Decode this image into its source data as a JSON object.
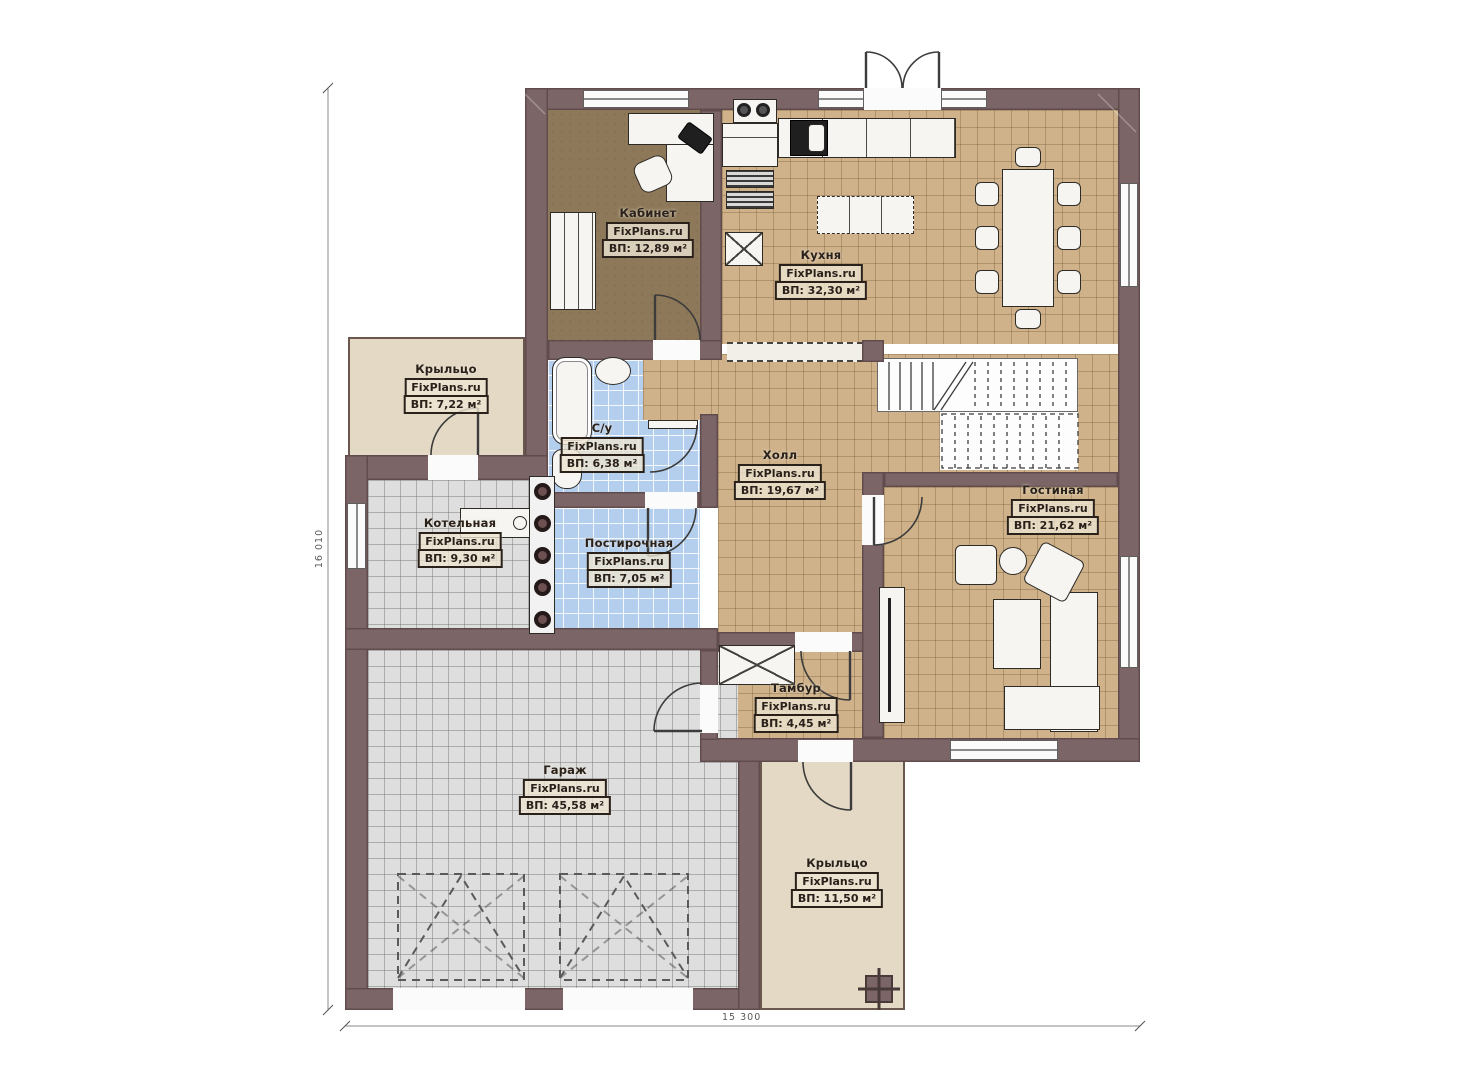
{
  "plan": {
    "brand": "FixPlans.ru",
    "rooms": [
      {
        "name": "Кабинет",
        "brand": "FixPlans.ru",
        "area": "ВП: 12,89 м²"
      },
      {
        "name": "Кухня",
        "brand": "FixPlans.ru",
        "area": "ВП: 32,30 м²"
      },
      {
        "name": "Крыльцо",
        "brand": "FixPlans.ru",
        "area": "ВП: 7,22 м²"
      },
      {
        "name": "С/у",
        "brand": "FixPlans.ru",
        "area": "ВП: 6,38 м²"
      },
      {
        "name": "Холл",
        "brand": "FixPlans.ru",
        "area": "ВП: 19,67 м²"
      },
      {
        "name": "Гостиная",
        "brand": "FixPlans.ru",
        "area": "ВП: 21,62 м²"
      },
      {
        "name": "Котельная",
        "brand": "FixPlans.ru",
        "area": "ВП: 9,30 м²"
      },
      {
        "name": "Постирочная",
        "brand": "FixPlans.ru",
        "area": "ВП: 7,05 м²"
      },
      {
        "name": "Тамбур",
        "brand": "FixPlans.ru",
        "area": "ВП: 4,45 м²"
      },
      {
        "name": "Гараж",
        "brand": "FixPlans.ru",
        "area": "ВП: 45,58 м²"
      },
      {
        "name": "Крыльцо",
        "brand": "FixPlans.ru",
        "area": "ВП: 11,50 м²"
      }
    ],
    "dimensions": {
      "height_total": "16 010",
      "width_total": "15 300"
    }
  },
  "colors": {
    "wall": "#7b6566",
    "tan": "#cfb28a",
    "gray": "#dedede",
    "blue": "#b4cfee",
    "office": "#8d7859",
    "porch": "#e3d9c5",
    "ink": "#2a211b",
    "labelbg": "#ece4d1",
    "line": "#3c3c3c"
  }
}
